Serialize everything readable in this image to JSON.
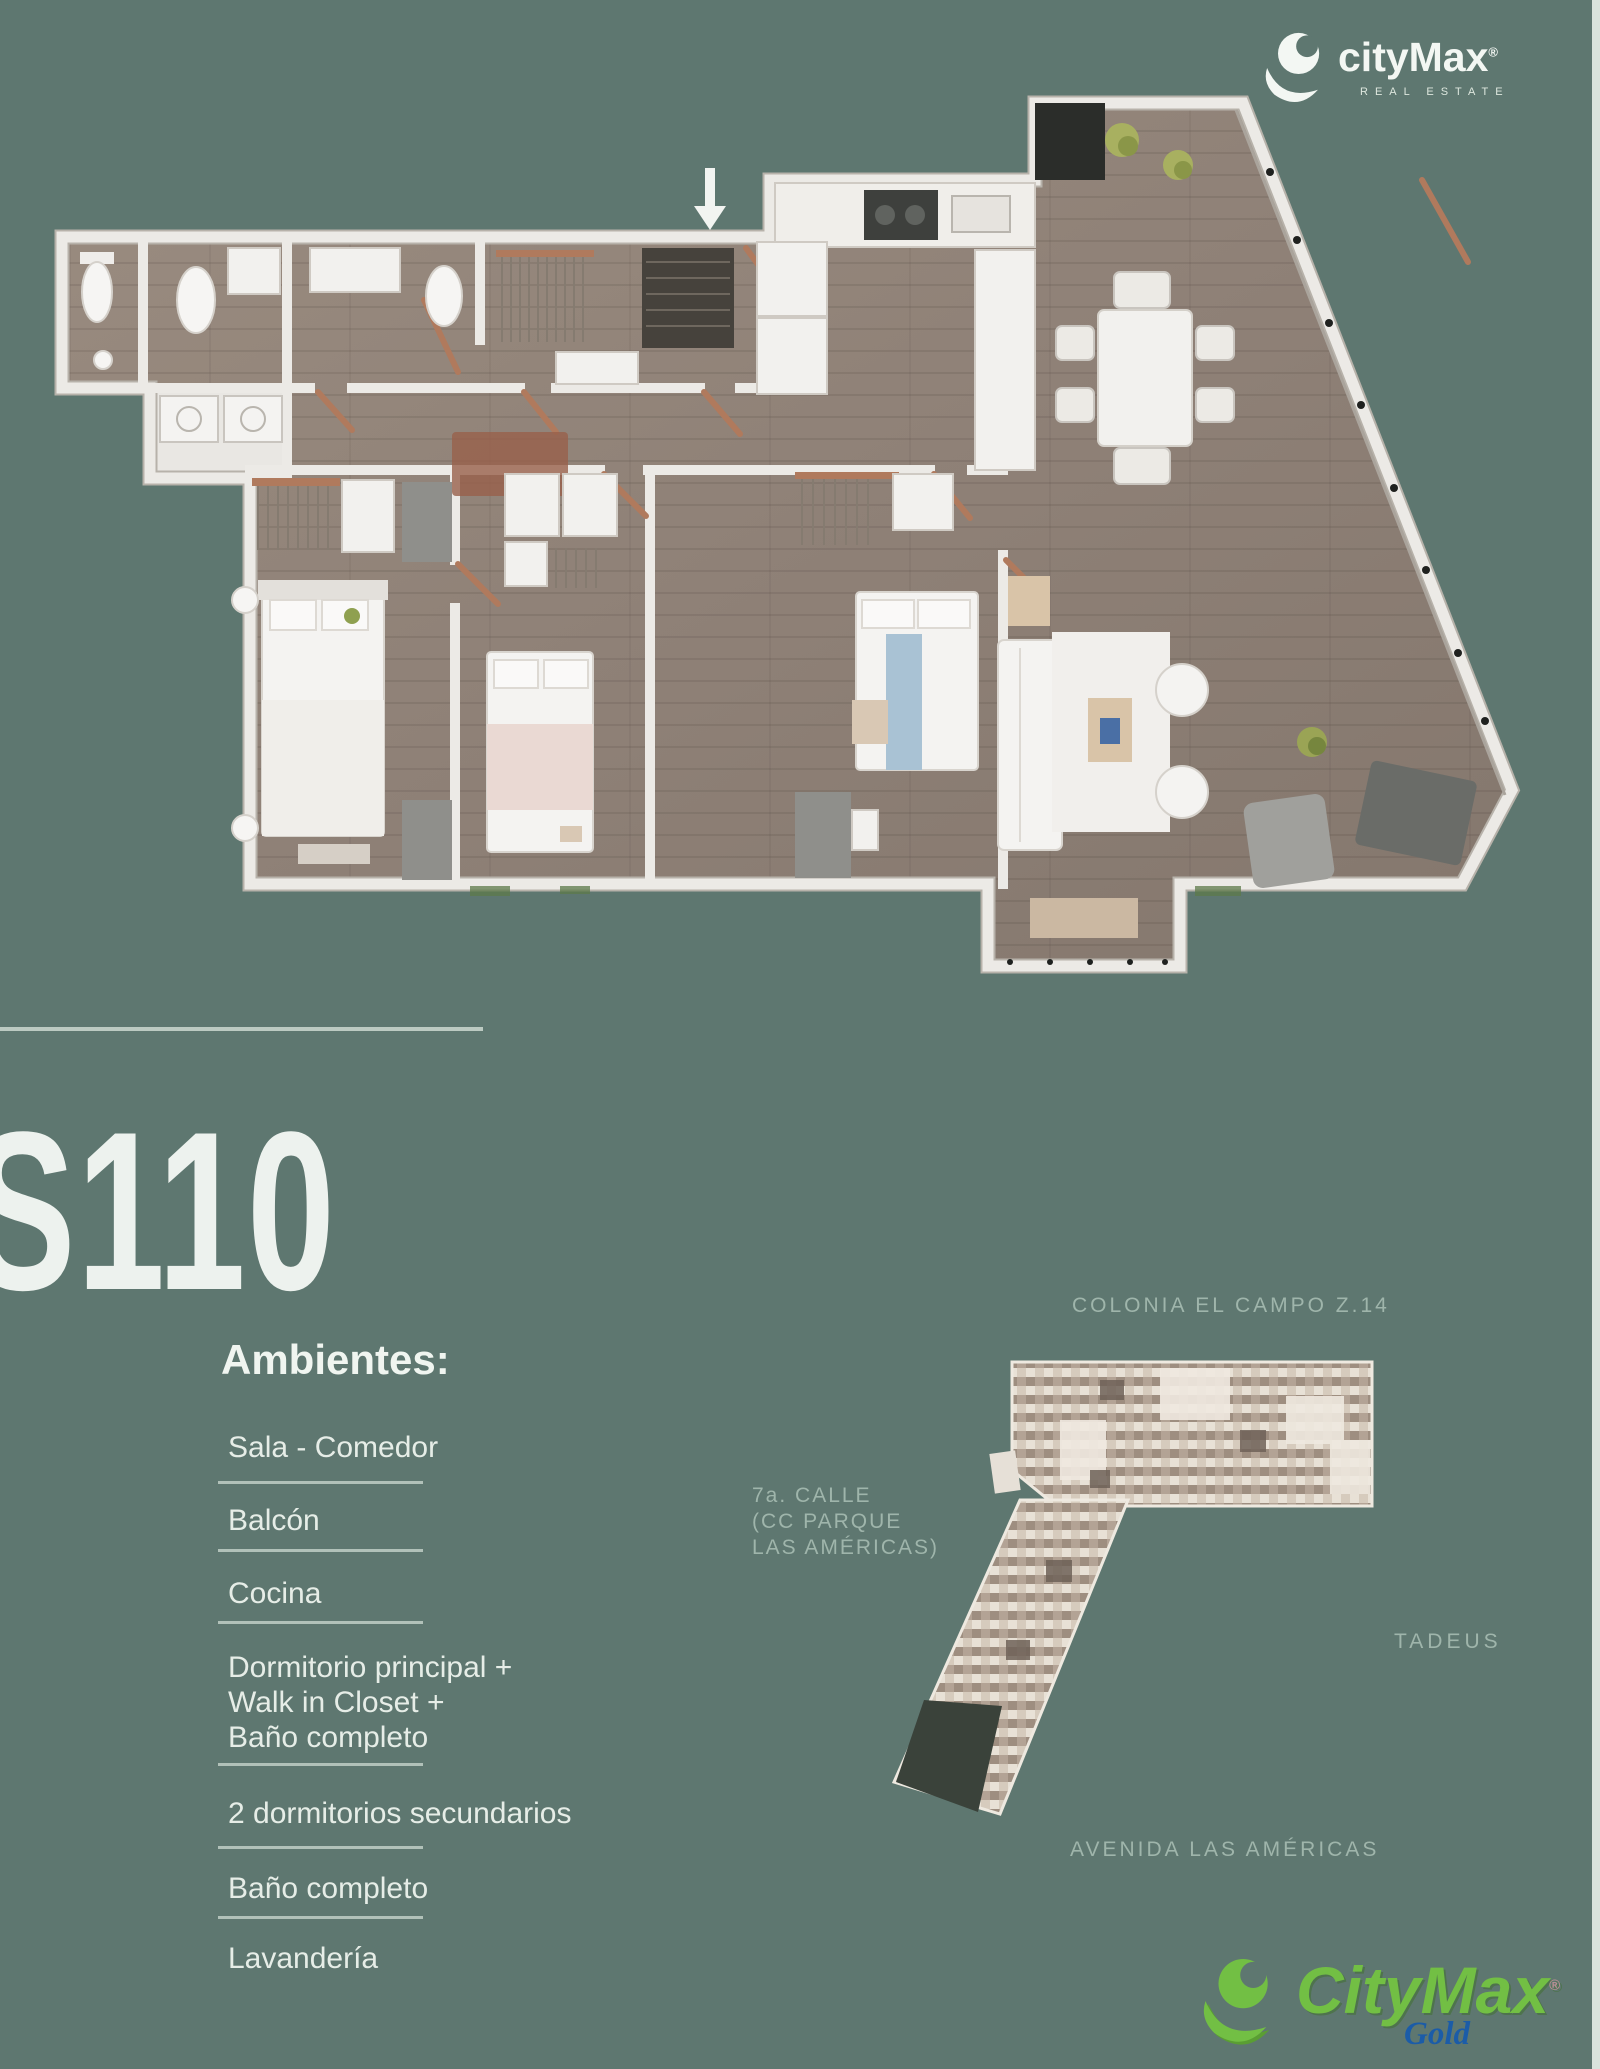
{
  "page": {
    "background": "#5E7770",
    "right_edge_strip": "#D9E3DC",
    "divider_color": "#C6D3CB"
  },
  "brand_top": {
    "logo_text": "cityMax",
    "registered": "®",
    "tagline": "REAL ESTATE",
    "text_color": "#F3F7F3"
  },
  "unit": {
    "code": "S110"
  },
  "ambientes": {
    "heading": "Ambientes:",
    "items": [
      {
        "lines": [
          "Sala - Comedor"
        ]
      },
      {
        "lines": [
          "Balcón"
        ]
      },
      {
        "lines": [
          "Cocina"
        ]
      },
      {
        "lines": [
          "Dormitorio principal +",
          "Walk in Closet +",
          "Baño completo"
        ]
      },
      {
        "lines": [
          "2 dormitorios secundarios"
        ]
      },
      {
        "lines": [
          "Baño completo"
        ]
      },
      {
        "lines": [
          "Lavandería"
        ]
      }
    ]
  },
  "site_map": {
    "label_top": "COLONIA EL CAMPO Z.14",
    "label_left_lines": [
      "7a. CALLE",
      "(CC PARQUE",
      "LAS AMÉRICAS)"
    ],
    "label_right": "TADEUS",
    "label_bottom": "AVENIDA LAS AMÉRICAS",
    "label_color": "#9FB5AB"
  },
  "brand_bottom": {
    "logo_text": "CityMax",
    "registered": "®",
    "sub_label": "Gold",
    "logo_color": "#72BF44",
    "sub_color": "#1B5CA8"
  },
  "floor_plan": {
    "entrance_arrow_direction": "down",
    "colors": {
      "wood_floor": "#8F8177",
      "walls": "#ECEAE6",
      "white_floor": "#E9E7E3",
      "copper_doors": "#B07A5D",
      "plants": "#A8B060",
      "dark_planter": "#2B2D2A",
      "gray_furniture": "#8F8F8B"
    }
  }
}
